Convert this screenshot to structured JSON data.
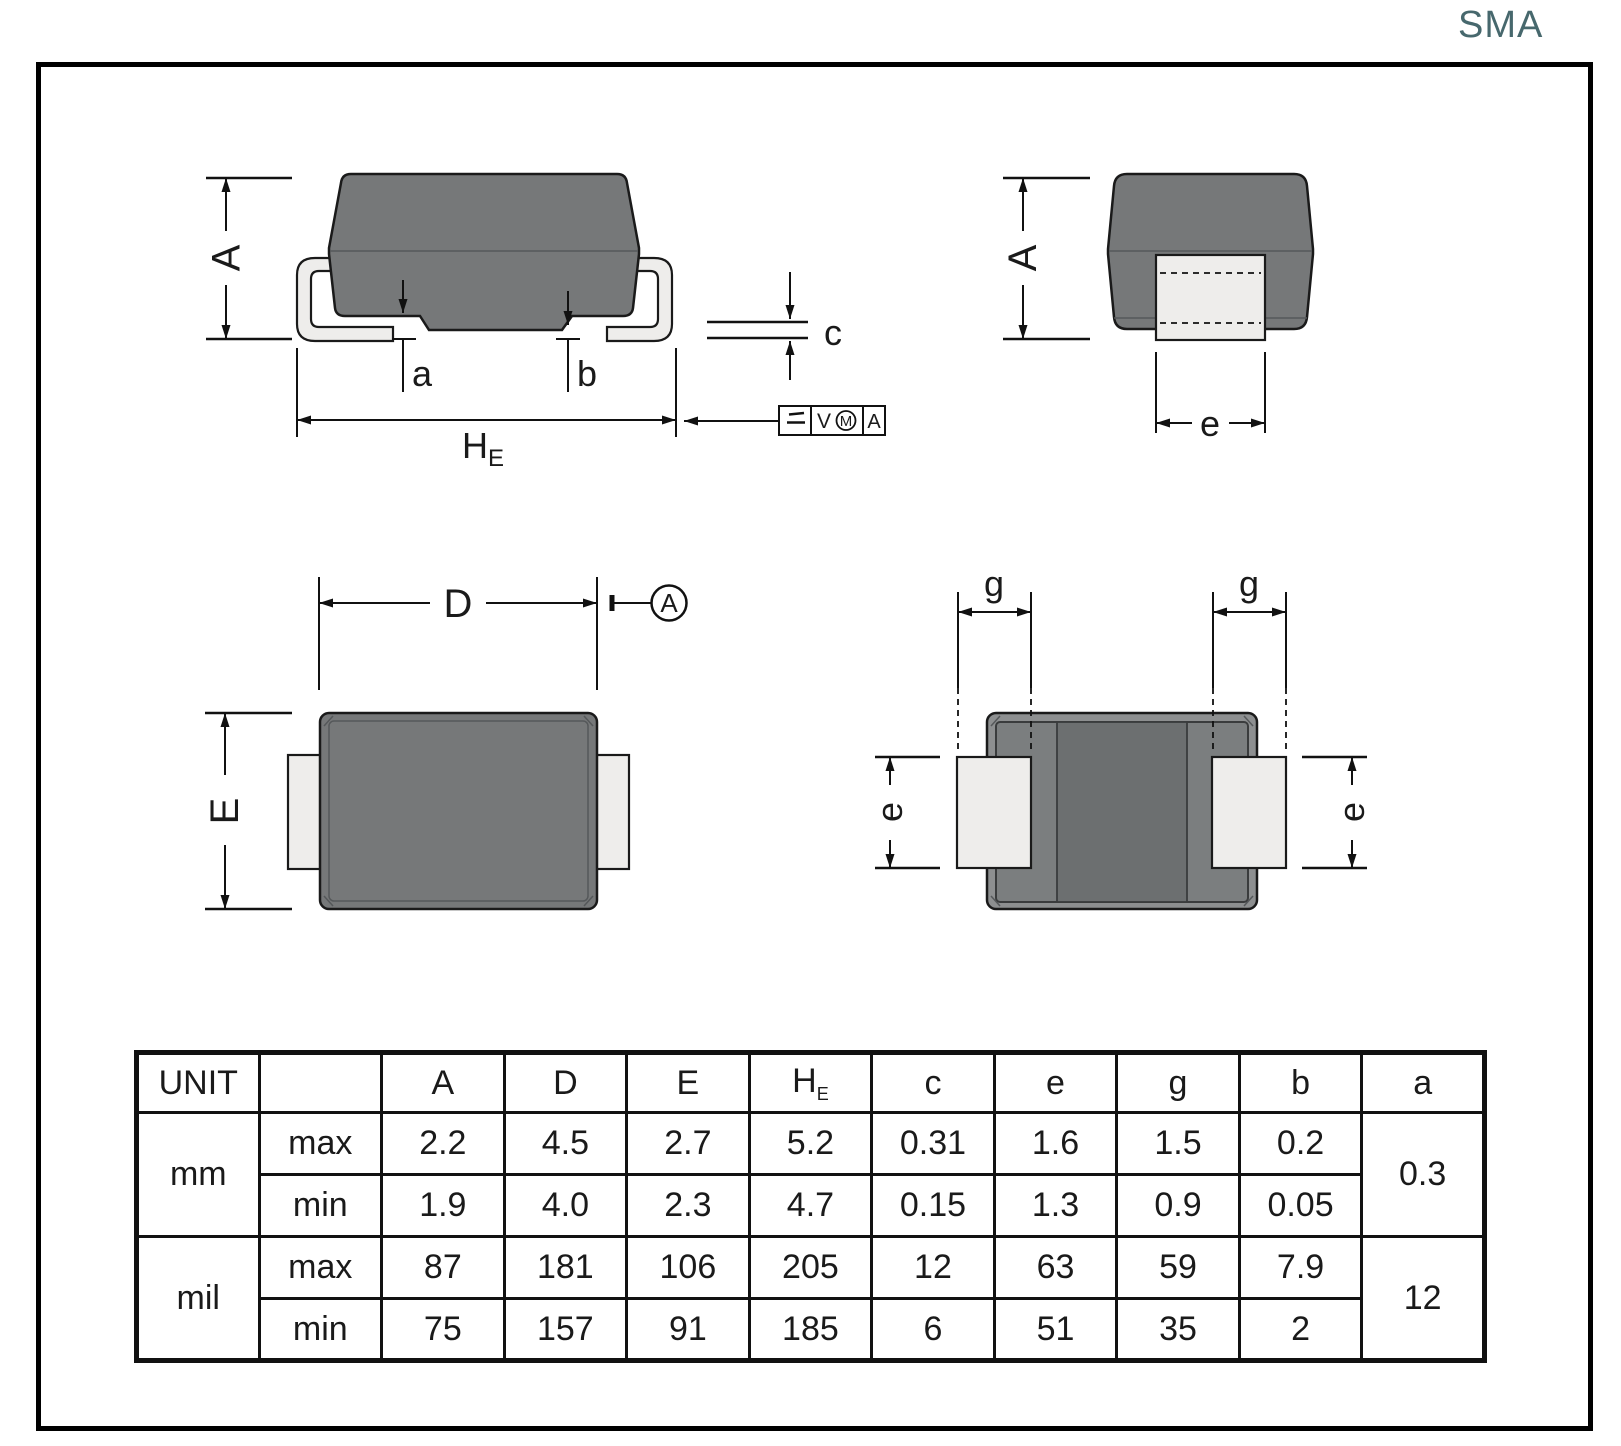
{
  "title": "SMA",
  "colors": {
    "accent": "#47686d",
    "body_gray": "#767879",
    "rim_gray": "#8d8f90",
    "band_gray": "#7b7e7f",
    "center_gray": "#6c6f70",
    "lead_gray": "#eeedeb",
    "line": "#111111"
  },
  "labels": {
    "A": "A",
    "D": "D",
    "E": "E",
    "H": "H",
    "E_sub": "E",
    "a": "a",
    "b": "b",
    "c": "c",
    "e": "e",
    "g": "g",
    "datum_a": "A",
    "fcf_v": "V",
    "fcf_m": "M",
    "fcf_a": "A"
  },
  "table": {
    "unit_header": "UNIT",
    "headers_left": [
      "A",
      "D",
      "E"
    ],
    "he_main": "H",
    "he_sub": "E",
    "headers_right": [
      "c",
      "e",
      "g",
      "b",
      "a"
    ],
    "rows": [
      {
        "unit": "mm",
        "bound": "max",
        "values": [
          "2.2",
          "4.5",
          "2.7",
          "5.2",
          "0.31",
          "1.6",
          "1.5",
          "0.2"
        ],
        "a": "0.3"
      },
      {
        "unit": "",
        "bound": "min",
        "values": [
          "1.9",
          "4.0",
          "2.3",
          "4.7",
          "0.15",
          "1.3",
          "0.9",
          "0.05"
        ]
      },
      {
        "unit": "mil",
        "bound": "max",
        "values": [
          "87",
          "181",
          "106",
          "205",
          "12",
          "63",
          "59",
          "7.9"
        ],
        "a": "12"
      },
      {
        "unit": "",
        "bound": "min",
        "values": [
          "75",
          "157",
          "91",
          "185",
          "6",
          "51",
          "35",
          "2"
        ]
      }
    ]
  }
}
